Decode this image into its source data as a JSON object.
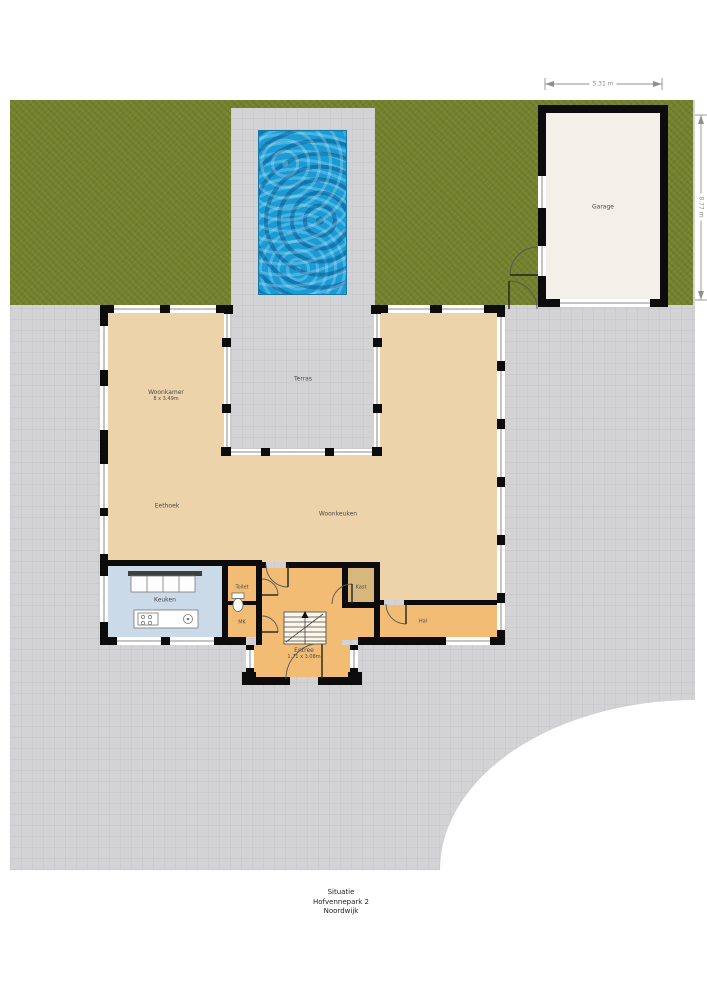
{
  "title_block": {
    "line1": "Situatie",
    "line2": "Hofvennepark 2",
    "line3": "Noordwijk"
  },
  "dimensions": {
    "garage_width": "5.31 m",
    "garage_height": "8.77 m"
  },
  "rooms": {
    "garage": "Garage",
    "woonkamer": "Woonkamer",
    "woonkamer_dim": "8 x 3.49m",
    "terras": "Terras",
    "eethoek": "Eethoek",
    "woonkeuken": "Woonkeuken",
    "keuken": "Keuken",
    "toilet": "Toilet",
    "mk": "MK",
    "kast": "Kast",
    "entree": "Entree",
    "entree_dim": "1.71 x 3.08m",
    "hal": "Hal"
  },
  "colors": {
    "garden": "#75832e",
    "paving": "#d3d3d5",
    "pool_water": "#1c9ad4",
    "room_tan": "#edd3a9",
    "room_orange": "#f2bc75",
    "kitchen_blue": "#cbdae9",
    "kast_tan": "#d8b77c",
    "garage_floor": "#f2f0e8",
    "wall": "#0c0c0c"
  }
}
